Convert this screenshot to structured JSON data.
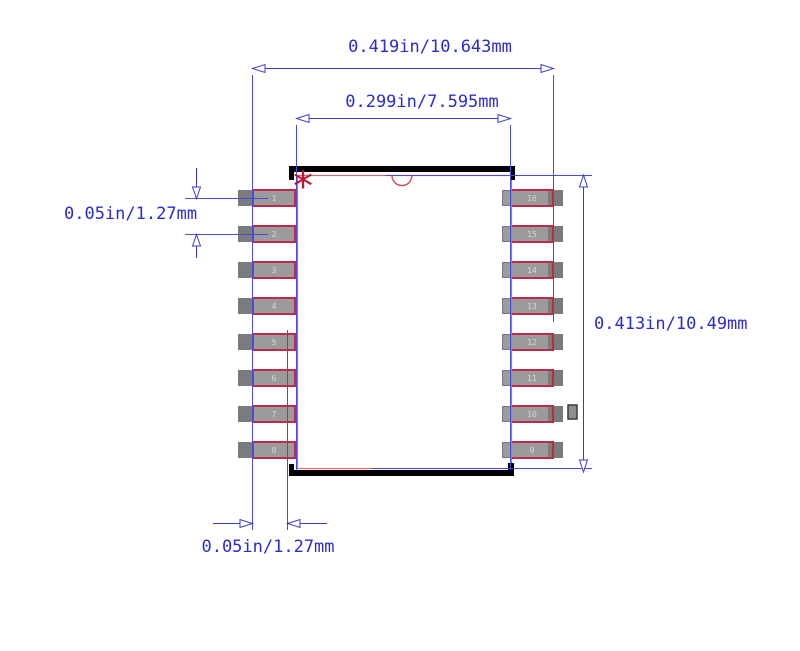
{
  "diagram": {
    "title": "16-pin SOIC package land pattern drawing",
    "dimensions": {
      "top_outer": "0.419in/10.643mm",
      "top_inner": "0.299in/7.595mm",
      "left_pitch": "0.05in/1.27mm",
      "right_span": "0.413in/10.49mm",
      "bottom_pitch": "0.05in/1.27mm"
    },
    "pin1_marker": "*",
    "pads": {
      "left_numbers": [
        "1",
        "2",
        "3",
        "4",
        "5",
        "6",
        "7",
        "8"
      ],
      "right_numbers": [
        "16",
        "15",
        "14",
        "13",
        "12",
        "11",
        "10",
        "9"
      ]
    },
    "colors": {
      "dimension_blue": "#2b2bcf",
      "lead_outline_red": "#bf2b45",
      "body_outline_red": "#d96b6b",
      "pad_gray": "#9b9b9b",
      "pad_uncovered_gray": "#7b7b7b",
      "pin1_marker_red": "#c41230",
      "assembly_black": "#000000"
    }
  }
}
